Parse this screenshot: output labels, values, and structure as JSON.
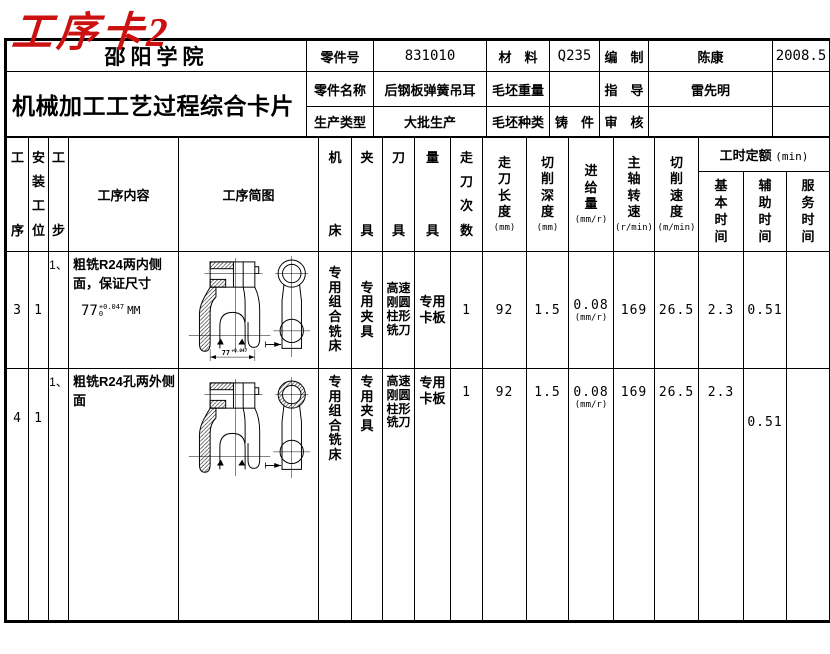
{
  "title": "工序卡2",
  "info": {
    "school": "邵阳学院",
    "doc_title": "机械加工工艺过程综合卡片",
    "part_no_label": "零件号",
    "part_no": "831010",
    "material_label": "材　料",
    "material": "Q235",
    "compile_label": "编　制",
    "compiler": "陈康",
    "date": "2008.5",
    "part_name_label": "零件名称",
    "part_name": "后钢板弹簧吊耳",
    "blank_weight_label": "毛坯重量",
    "blank_weight": "",
    "advise_label": "指　导",
    "advisor": "雷先明",
    "prod_type_label": "生产类型",
    "prod_type": "大批生产",
    "blank_kind_label": "毛坯种类",
    "blank_kind": "铸　件",
    "audit_label": "审　核",
    "auditor": ""
  },
  "cols": {
    "no": "工序",
    "setup": "安装工位",
    "step": "工步",
    "content": "工序内容",
    "sketch": "工序简图",
    "machine": "机床",
    "fixture": "夹具",
    "tool": "刀具",
    "gauge": "量具",
    "passes": "走刀次数",
    "length": "走刀长度",
    "length_u": "(mm)",
    "depth": "切削深度",
    "depth_u": "(mm)",
    "feed": "进给量",
    "feed_u": "(mm/r)",
    "speed": "主轴转速",
    "speed_u": "(r/min)",
    "vcut": "切削速度",
    "vcut_u": "(m/min)",
    "quota": "工时定额",
    "quota_u": "(min)",
    "t_basic": "基本时间",
    "t_aux": "辅助时间",
    "t_srv": "服务时间"
  },
  "rows": [
    {
      "no": "3",
      "setup": "1",
      "step": "1、",
      "content": "粗铣R24两内侧面，保证尺寸",
      "dim": "77",
      "dim_sup": "+0.047",
      "dim_sub": "0",
      "dim_unit": "MM",
      "machine": "专用组合铣床",
      "fixture": "专用夹具",
      "tool": "高速刚圆柱形铣刀",
      "gauge": "专用卡板",
      "passes": "1",
      "length": "92",
      "depth": "1.5",
      "feed": "0.08",
      "feed_note": "(mm/r)",
      "speed": "169",
      "vcut": "26.5",
      "t_basic": "2.3",
      "t_aux": "0.51",
      "t_srv": "",
      "sketch_dim": "77",
      "sketch_dim_tol": "+0.047"
    },
    {
      "no": "4",
      "setup": "1",
      "step": "1、",
      "content": "粗铣R24孔两外侧面",
      "machine": "专用组合铣床",
      "fixture": "专用夹具",
      "tool": "高速刚圆柱形铣刀",
      "gauge": "专用卡板",
      "passes": "1",
      "length": "92",
      "depth": "1.5",
      "feed": "0.08",
      "feed_note": "(mm/r)",
      "speed": "169",
      "vcut": "26.5",
      "t_basic": "2.3",
      "t_aux": "0.51",
      "t_srv": ""
    }
  ]
}
